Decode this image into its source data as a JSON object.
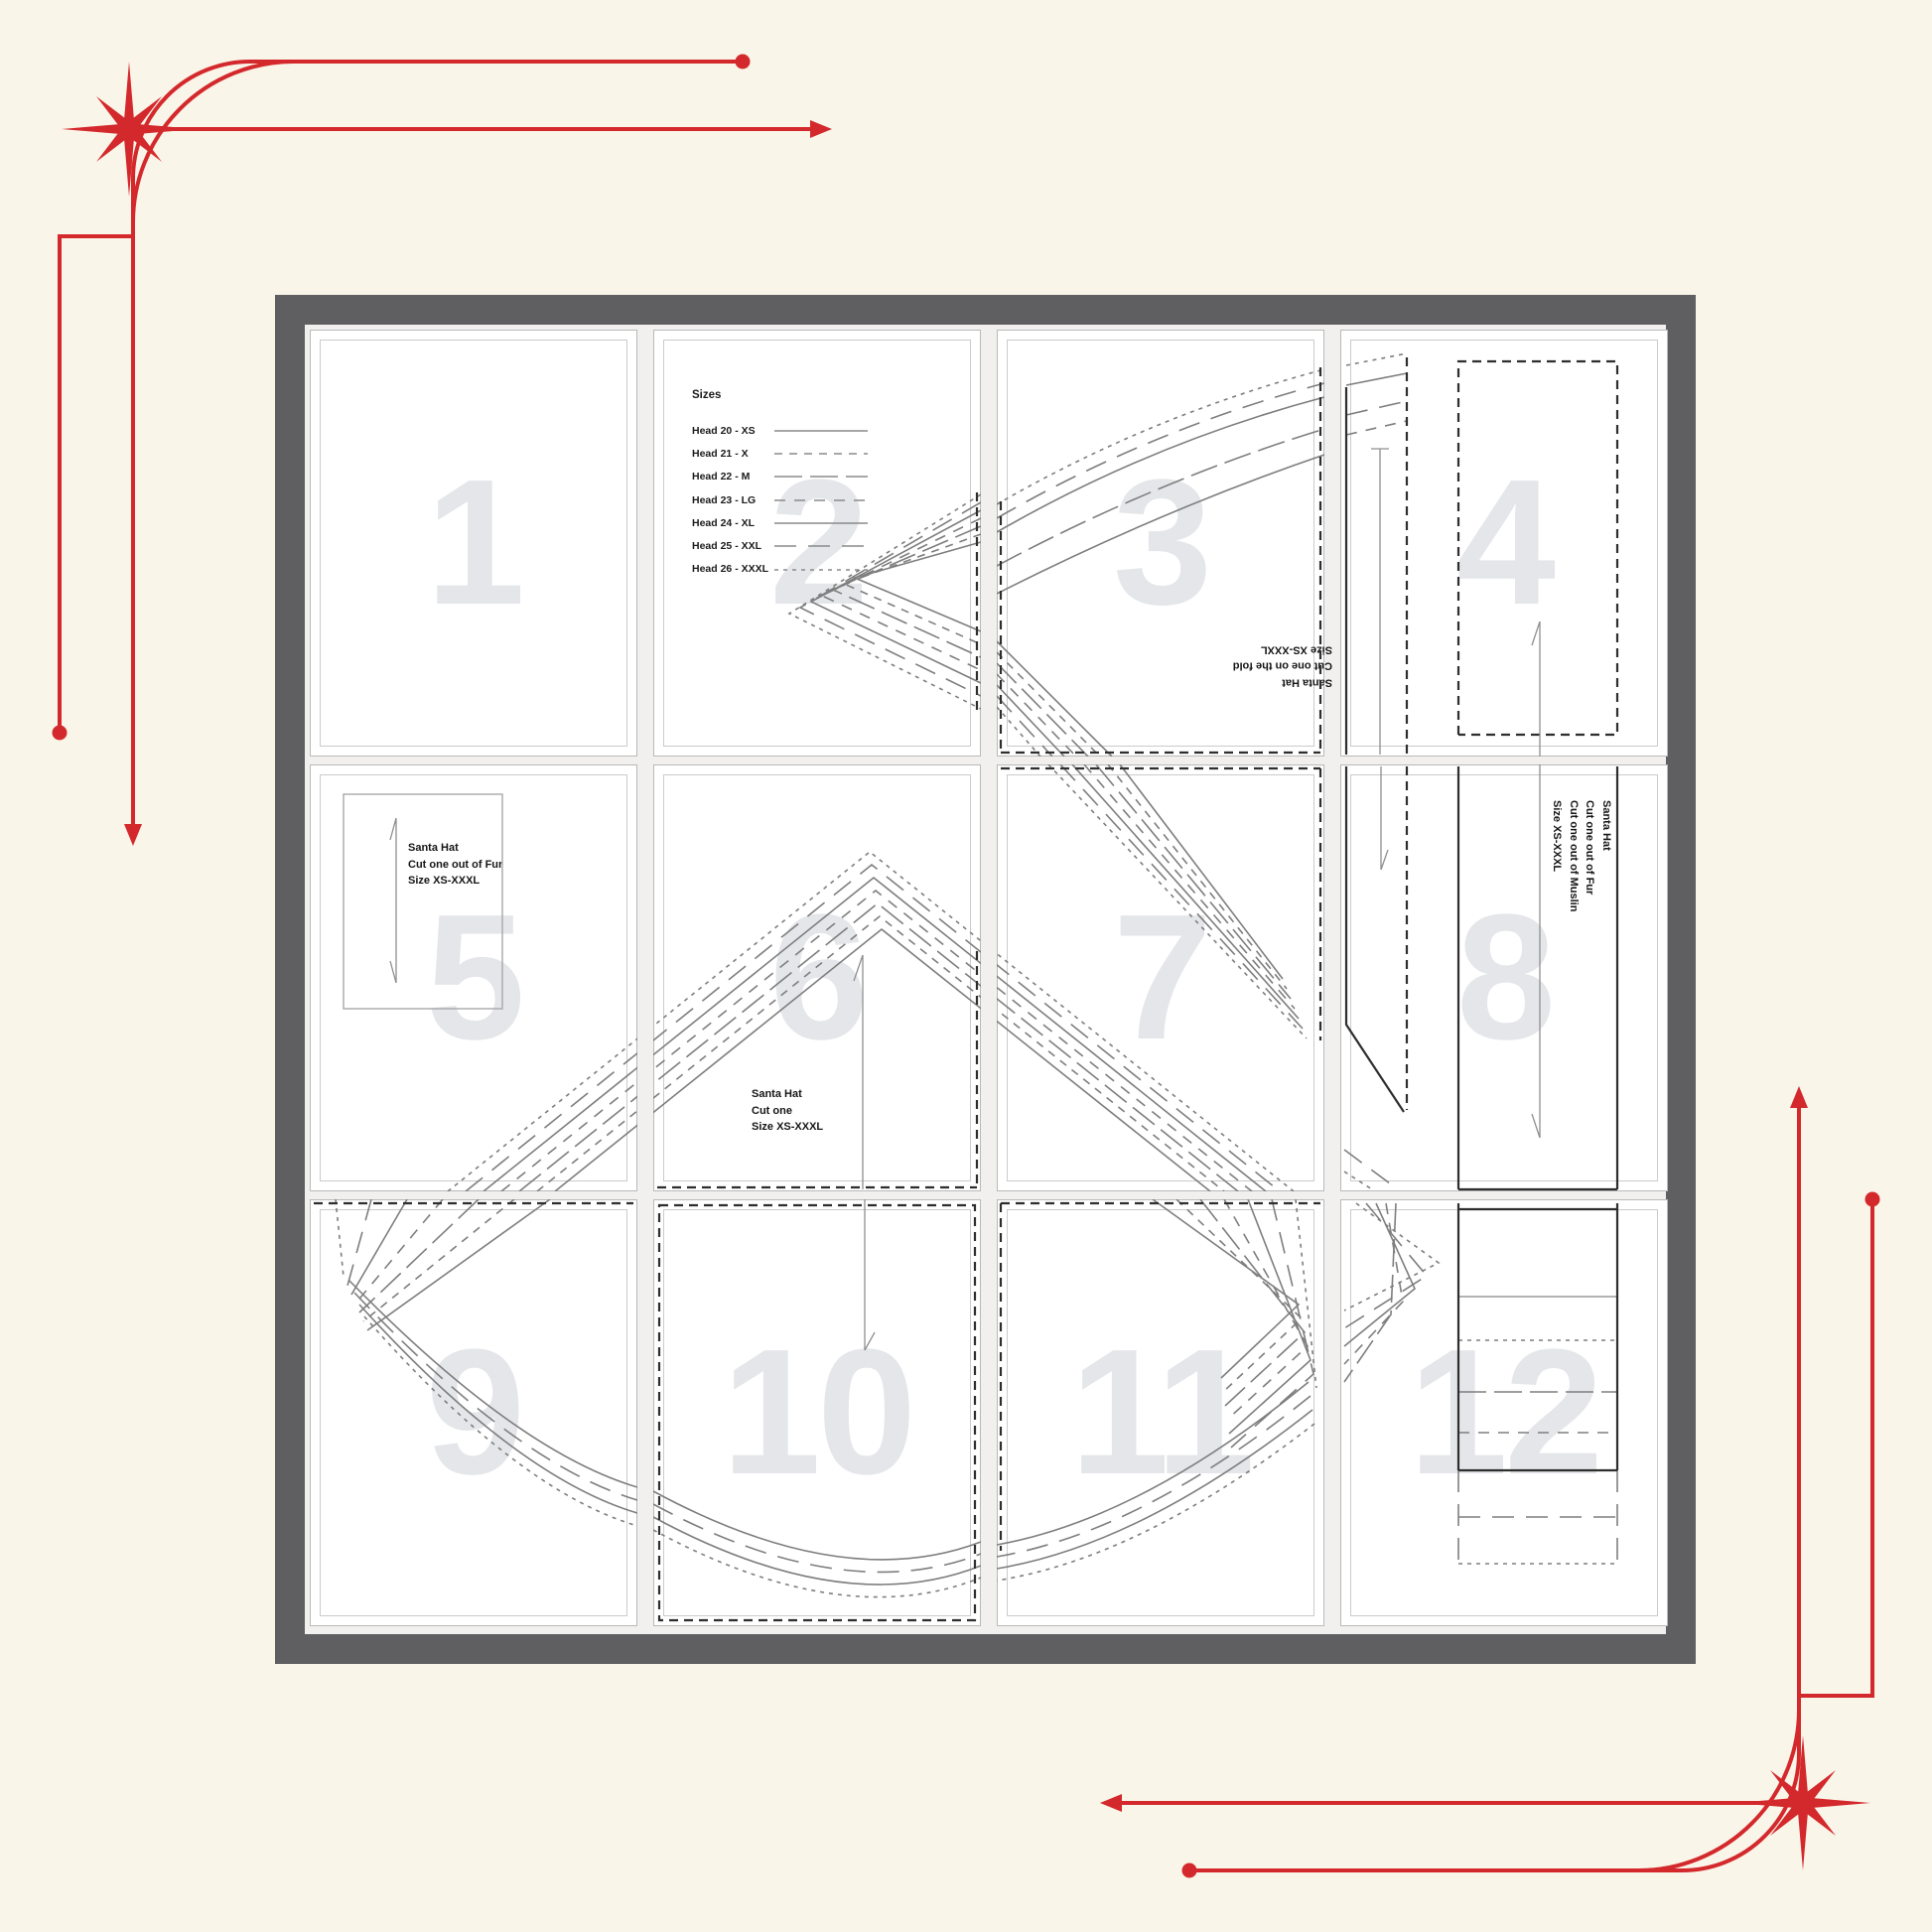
{
  "colors": {
    "accent": "#d4292c",
    "canvas-bg": "#faf5e9",
    "frame": "#5f5f61",
    "page-area-bg": "#f1f0ee",
    "page-bg": "#ffffff",
    "page-number": "#e4e6e9",
    "pattern-line": "#7e7e7e",
    "pattern-dark": "#2e2e2e"
  },
  "pages": [
    {
      "number": "1"
    },
    {
      "number": "2"
    },
    {
      "number": "3"
    },
    {
      "number": "4"
    },
    {
      "number": "5"
    },
    {
      "number": "6"
    },
    {
      "number": "7"
    },
    {
      "number": "8"
    },
    {
      "number": "9"
    },
    {
      "number": "10"
    },
    {
      "number": "11"
    },
    {
      "number": "12"
    }
  ],
  "legend": {
    "title": "Sizes",
    "entries": [
      {
        "label": "Head 20 - XS",
        "style": "solid"
      },
      {
        "label": "Head 21 - X",
        "style": "dashed"
      },
      {
        "label": "Head 22 - M",
        "style": "long-dash"
      },
      {
        "label": "Head 23 - LG",
        "style": "dash-dot"
      },
      {
        "label": "Head 24 - XL",
        "style": "solid"
      },
      {
        "label": "Head 25 - XXL",
        "style": "long-dash"
      },
      {
        "label": "Head 26 - XXXL",
        "style": "dotted"
      }
    ]
  },
  "labels": {
    "page3": {
      "lines": [
        "Santa Hat",
        "Cut one on the fold",
        "Size XS-XXXL"
      ],
      "rotation": 180
    },
    "page5": {
      "lines": [
        "Santa Hat",
        "Cut one out of Fur",
        "Size XS-XXXL"
      ],
      "rotation": 0
    },
    "page6": {
      "lines": [
        "Santa Hat",
        "Cut one",
        "Size XS-XXXL"
      ],
      "rotation": 0
    },
    "page8": {
      "lines": [
        "Santa Hat",
        "Cut one out of Fur",
        "Cut one out of Muslin",
        "Size XS-XXXL"
      ],
      "rotation": 90
    }
  }
}
